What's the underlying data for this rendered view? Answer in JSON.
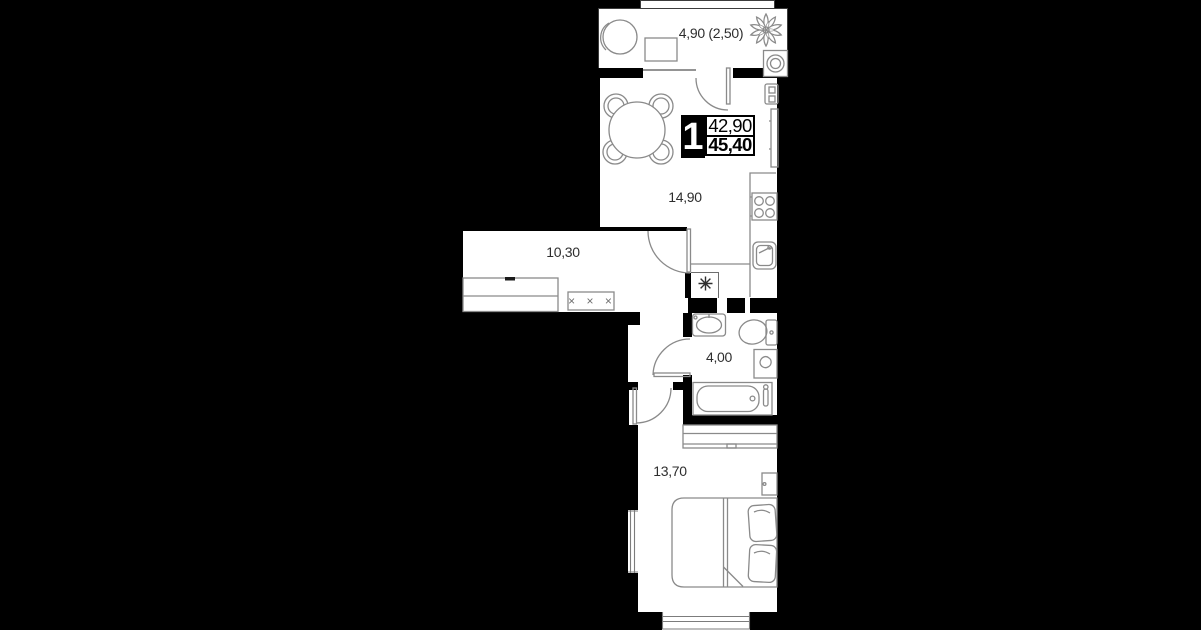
{
  "unit_card": {
    "rooms_count": "1",
    "area_upper": "42,90",
    "area_lower": "45,40"
  },
  "room_labels": {
    "balcony": "4,90 (2,50)",
    "kitchen_living": "14,90",
    "hallway": "10,30",
    "bathroom": "4,00",
    "bedroom": "13,70"
  },
  "symbols": {
    "hanger_marks": "× × ×"
  },
  "colors": {
    "background": "#000000",
    "wall": "#000000",
    "floor": "#ffffff",
    "furniture_line": "#8a8a8a",
    "text": "#2e2e2e"
  }
}
